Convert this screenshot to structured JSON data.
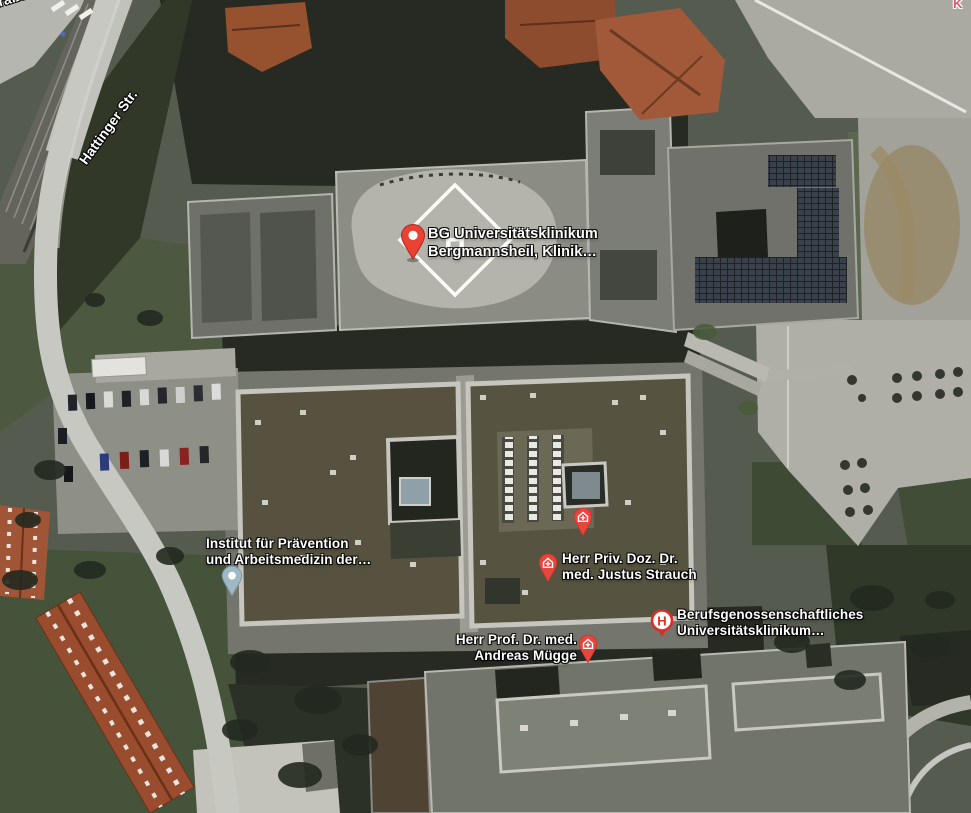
{
  "view": {
    "type": "satellite-map"
  },
  "labels": {
    "street_hattinger": "Hattinger Str.",
    "street_strasse_partial": "straße",
    "poi_partial_top_right": "K"
  },
  "helipad": {
    "symbol": "H"
  },
  "markers": {
    "bergmannsheil": {
      "type": "large-red-place-pin",
      "pin_color": "#EA4335",
      "label_line1": "BG Universitätsklinikum",
      "label_line2": "Bergmannsheil, Klinik…"
    },
    "institut": {
      "type": "small-blue-place-pin",
      "pin_color": "#9FB9C4",
      "label_line1": "Institut für Prävention",
      "label_line2": "und Arbeitsmedizin der…"
    },
    "unnamed_health_building": {
      "type": "health-facility-pin",
      "pin_color": "#E8453C"
    },
    "strauch": {
      "type": "health-facility-pin",
      "pin_color": "#E8453C",
      "label_line1": "Herr Priv. Doz. Dr.",
      "label_line2": "med. Justus Strauch"
    },
    "muegge": {
      "type": "health-facility-pin",
      "pin_color": "#E8453C",
      "label_line1": "Herr Prof. Dr. med.",
      "label_line2": "Andreas Mügge"
    },
    "klinikum_h": {
      "type": "hospital-h-pin",
      "pin_color": "#D93025",
      "symbol": "H",
      "label_line1": "Berufsgenossenschaftliches",
      "label_line2": "Universitätsklinikum…"
    }
  }
}
